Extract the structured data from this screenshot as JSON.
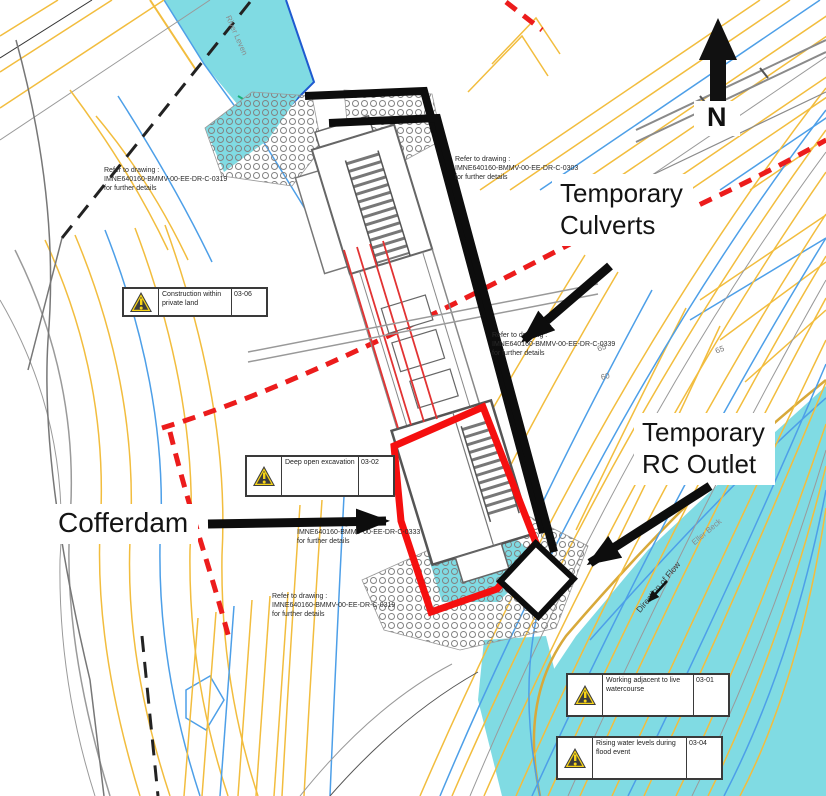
{
  "compass": {
    "label": "N"
  },
  "callouts": {
    "culverts": {
      "line1": "Temporary",
      "line2": "Culverts"
    },
    "rc_outlet": {
      "line1": "Temporary",
      "line2": "RC Outlet"
    },
    "cofferdam": {
      "label": "Cofferdam"
    }
  },
  "notes": [
    {
      "line1": "Refer to drawing :",
      "line2": "IMNE640160-BMMV-00-EE-DR-C-0319",
      "line3": "for further details"
    },
    {
      "line1": "Refer to drawing :",
      "line2": "IMNE640160-BMMV-00-EE-DR-C-0303",
      "line3": "for further details"
    },
    {
      "line1": "Refer to drawing :",
      "line2": "IMNE640160-BMMV-00-EE-DR-C-0339",
      "line3": "for further details"
    },
    {
      "line1": "Refer to drawing :",
      "line2": "IMNE640160-BMMV-00-EE-DR-C-0333",
      "line3": "for further details"
    },
    {
      "line1": "Refer to drawing :",
      "line2": "IMNE640160-BMMV-00-EE-DR-C-0319",
      "line3": "for further details"
    }
  ],
  "hazards": [
    {
      "text": "Construction within private land",
      "code": "03-06"
    },
    {
      "text": "Deep open excavation",
      "code": "03-02"
    },
    {
      "text": "Working adjacent to live watercourse",
      "code": "03-01"
    },
    {
      "text": "Rising water levels during flood event",
      "code": "03-04"
    }
  ],
  "water_labels": {
    "river_top": "River Leven",
    "river_right": "Eller Beck",
    "flow": "Direction of Flow"
  },
  "contour_labels": [
    {
      "text": "65"
    },
    {
      "text": "60"
    },
    {
      "text": "65"
    }
  ],
  "colors": {
    "water": "#80DBE3",
    "contour_yellow": "#F2BD3E",
    "contour_blue": "#4D9FE8",
    "contour_gray": "#9A9A9A",
    "boundary_red": "#EC1C1C",
    "cofferdam_red": "#F50F0F",
    "callout_black": "#0D0D0D",
    "hazard_yellow": "#F7D417"
  }
}
